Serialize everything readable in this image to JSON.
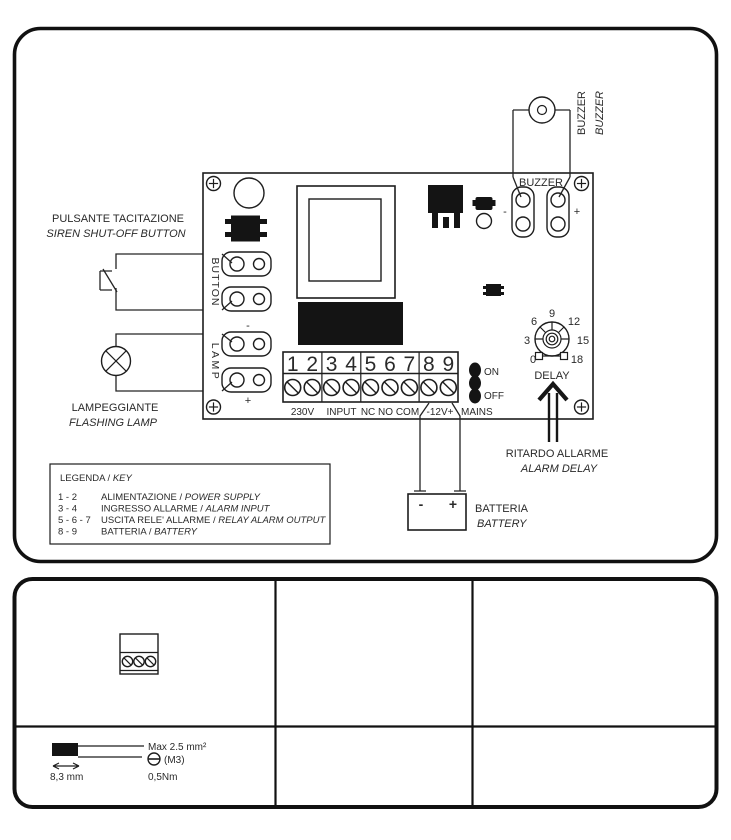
{
  "wiring": {
    "siren_button": {
      "it": "PULSANTE TACITAZIONE",
      "en": "SIREN SHUT-OFF BUTTON"
    },
    "flashing_lamp": {
      "it": "LAMPEGGIANTE",
      "en": "FLASHING LAMP"
    },
    "buzzer_external": {
      "it": "BUZZER",
      "en": "BUZZER"
    },
    "alarm_delay": {
      "it": "RITARDO ALLARME",
      "en": "ALARM DELAY"
    },
    "battery": {
      "it": "BATTERIA",
      "en": "BATTERY"
    },
    "board": {
      "buzzer": "BUZZER",
      "button": "BUTTON",
      "lamp": "LAMP",
      "delay": "DELAY",
      "on": "ON",
      "off": "OFF",
      "mains": "MAINS",
      "buzzer_minus": "-",
      "buzzer_plus": "+",
      "lamp_minus": "-",
      "lamp_plus": "+",
      "battery_minus": "-",
      "battery_plus": "+",
      "terminals": [
        "1",
        "2",
        "3",
        "4",
        "5",
        "6",
        "7",
        "8",
        "9"
      ],
      "terminal_groups": [
        "230V",
        "INPUT",
        "NC NO COM",
        "-12V+"
      ],
      "delay_scale": [
        "0",
        "3",
        "6",
        "9",
        "12",
        "15",
        "18"
      ]
    },
    "legend": {
      "title_it": "LEGENDA",
      "sep": " / ",
      "title_en": "KEY",
      "items": [
        {
          "pins": "1 - 2",
          "it": "ALIMENTAZIONE",
          "en": "POWER SUPPLY"
        },
        {
          "pins": "3 - 4",
          "it": "INGRESSO ALLARME",
          "en": "ALARM INPUT"
        },
        {
          "pins": "5 - 6 - 7",
          "it": "USCITA RELE' ALLARME",
          "en": "RELAY ALARM OUTPUT"
        },
        {
          "pins": "8 - 9",
          "it": "BATTERIA",
          "en": "BATTERY"
        }
      ]
    }
  },
  "spec": {
    "wire_max_section": "Max 2.5 mm²",
    "screw_size": "(M3)",
    "tightening_torque": "0,5Nm",
    "strip_length": "8,3 mm"
  },
  "colors": {
    "ink": "#141414",
    "text": "#2a2a2a",
    "background": "#ffffff"
  }
}
